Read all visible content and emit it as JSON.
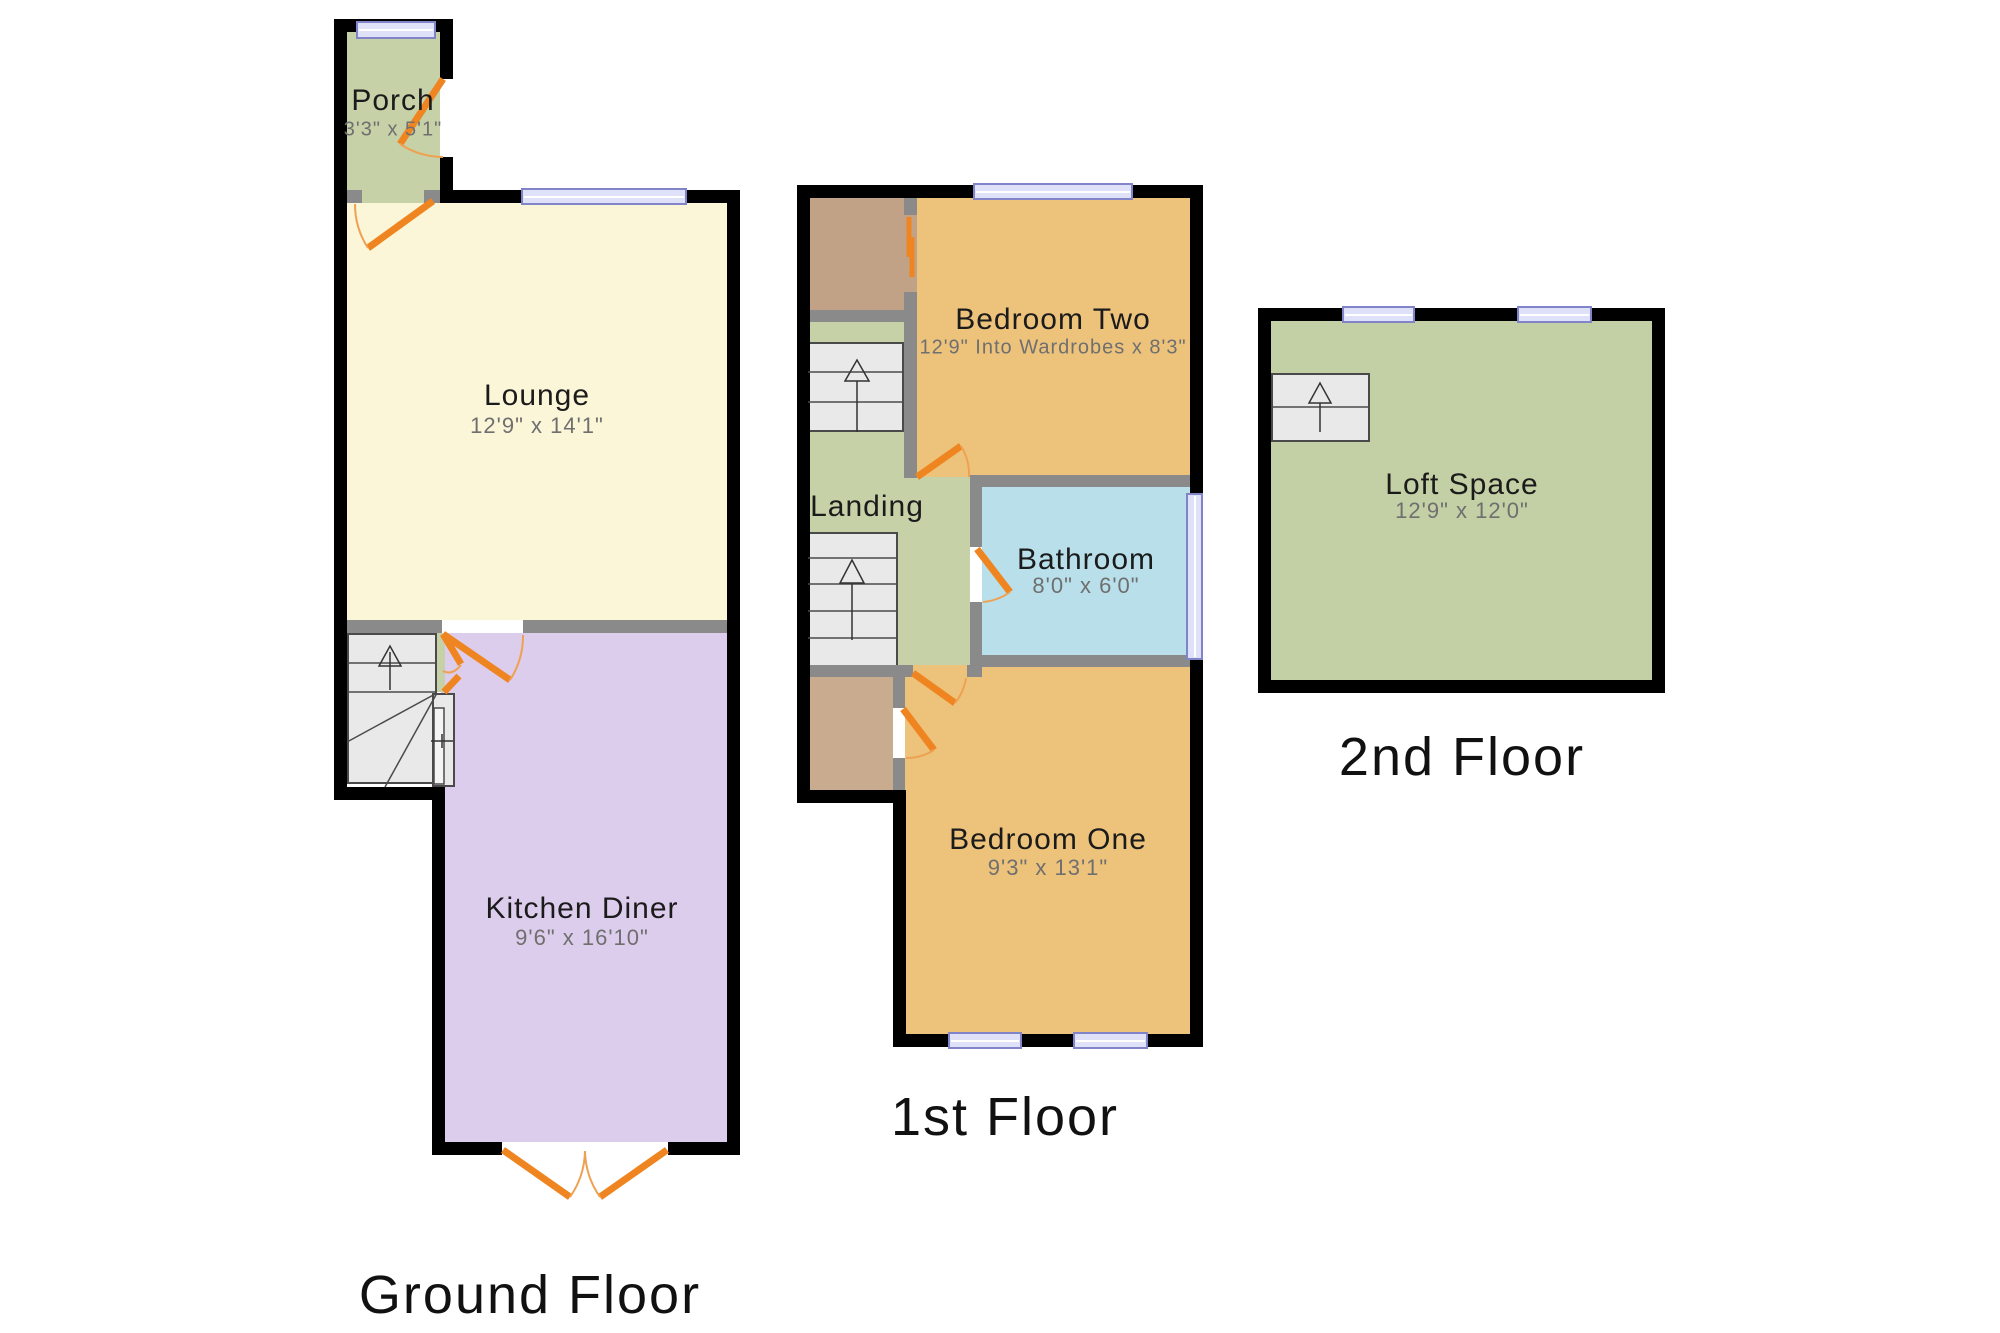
{
  "colors": {
    "wall": "#000000",
    "interior_wall": "#8a8a8a",
    "door": "#ef8520",
    "door_arc": "#efa153",
    "window_fill": "#dfe1f8",
    "window_border": "#8184c9",
    "stairs_fill": "#e9e9e9",
    "stairs_line": "#4a4a4a",
    "porch": "#c6d1a8",
    "lounge": "#fcf6d8",
    "kitchen": "#ddcdec",
    "bedroom": "#edc37c",
    "bathroom": "#b9e0ea",
    "landing": "#c6d1a8",
    "loft": "#c3cfa4",
    "closet": "#c9ab90",
    "cupboard_top": "#c2a287",
    "label": "#1b1b1b",
    "dims": "#6f6f6f"
  },
  "floors": {
    "ground": {
      "title": "Ground Floor"
    },
    "first": {
      "title": "1st Floor"
    },
    "second": {
      "title": "2nd Floor"
    }
  },
  "rooms": {
    "porch": {
      "name": "Porch",
      "dims": "3'3\" x 5'1\""
    },
    "lounge": {
      "name": "Lounge",
      "dims": "12'9\" x 14'1\""
    },
    "kitchen": {
      "name": "Kitchen Diner",
      "dims": "9'6\" x 16'10\""
    },
    "bedroom_two": {
      "name": "Bedroom Two",
      "dims": "12'9\" Into Wardrobes x 8'3\""
    },
    "landing": {
      "name": "Landing"
    },
    "bathroom": {
      "name": "Bathroom",
      "dims": "8'0\" x 6'0\""
    },
    "bedroom_one": {
      "name": "Bedroom One",
      "dims": "9'3\" x 13'1\""
    },
    "loft": {
      "name": "Loft Space",
      "dims": "12'9\" x 12'0\""
    }
  }
}
